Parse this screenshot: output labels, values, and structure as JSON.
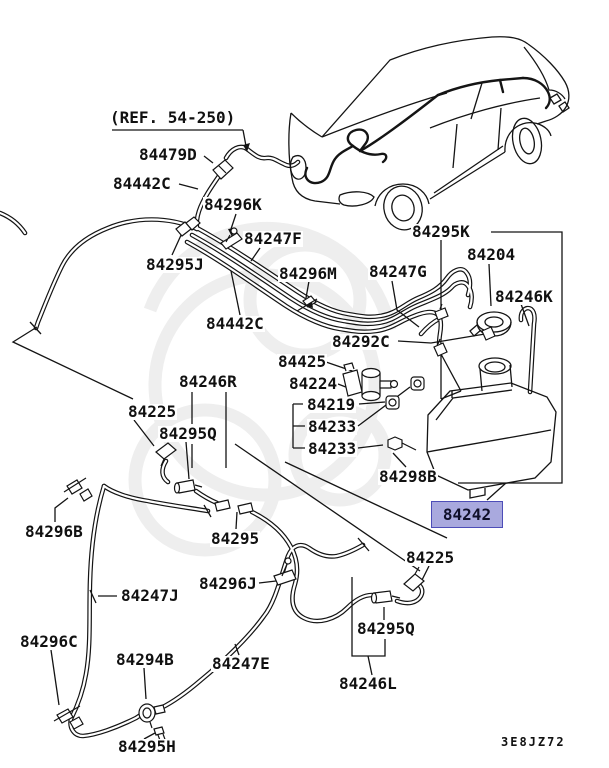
{
  "diagram": {
    "ref_note": "(REF. 54-250)",
    "drawing_code": "3E8JZ72",
    "highlight": {
      "part_number": "84242",
      "fill": "#a9a9de",
      "border": "#4d4db8",
      "x": 431,
      "y": 501,
      "width": 70,
      "height": 25
    },
    "colors": {
      "line": "#141414",
      "background": "#ffffff",
      "watermark": "#eeeeee"
    },
    "part_labels": [
      {
        "text": "84479D",
        "x": 138,
        "y": 147
      },
      {
        "text": "84442C",
        "x": 112,
        "y": 176
      },
      {
        "text": "84296K",
        "x": 203,
        "y": 197
      },
      {
        "text": "84247F",
        "x": 243,
        "y": 231
      },
      {
        "text": "84295J",
        "x": 145,
        "y": 257
      },
      {
        "text": "84296M",
        "x": 278,
        "y": 266
      },
      {
        "text": "84247G",
        "x": 368,
        "y": 264
      },
      {
        "text": "84295K",
        "x": 411,
        "y": 224
      },
      {
        "text": "84204",
        "x": 466,
        "y": 247
      },
      {
        "text": "84246K",
        "x": 494,
        "y": 289
      },
      {
        "text": "84442C",
        "x": 205,
        "y": 316
      },
      {
        "text": "84292C",
        "x": 331,
        "y": 334
      },
      {
        "text": "84425",
        "x": 277,
        "y": 354
      },
      {
        "text": "84224",
        "x": 288,
        "y": 376
      },
      {
        "text": "84219",
        "x": 306,
        "y": 397
      },
      {
        "text": "84233",
        "x": 307,
        "y": 419
      },
      {
        "text": "84233",
        "x": 307,
        "y": 441
      },
      {
        "text": "84246R",
        "x": 178,
        "y": 374
      },
      {
        "text": "84225",
        "x": 127,
        "y": 404
      },
      {
        "text": "84295Q",
        "x": 158,
        "y": 426
      },
      {
        "text": "84298B",
        "x": 378,
        "y": 469
      },
      {
        "text": "84296B",
        "x": 24,
        "y": 524
      },
      {
        "text": "84295",
        "x": 210,
        "y": 531
      },
      {
        "text": "84296J",
        "x": 198,
        "y": 576
      },
      {
        "text": "84225",
        "x": 405,
        "y": 550
      },
      {
        "text": "84247J",
        "x": 120,
        "y": 588
      },
      {
        "text": "84295Q",
        "x": 356,
        "y": 621
      },
      {
        "text": "84296C",
        "x": 19,
        "y": 634
      },
      {
        "text": "84294B",
        "x": 115,
        "y": 652
      },
      {
        "text": "84247E",
        "x": 211,
        "y": 656
      },
      {
        "text": "84246L",
        "x": 338,
        "y": 676
      },
      {
        "text": "84295H",
        "x": 117,
        "y": 739
      }
    ]
  }
}
